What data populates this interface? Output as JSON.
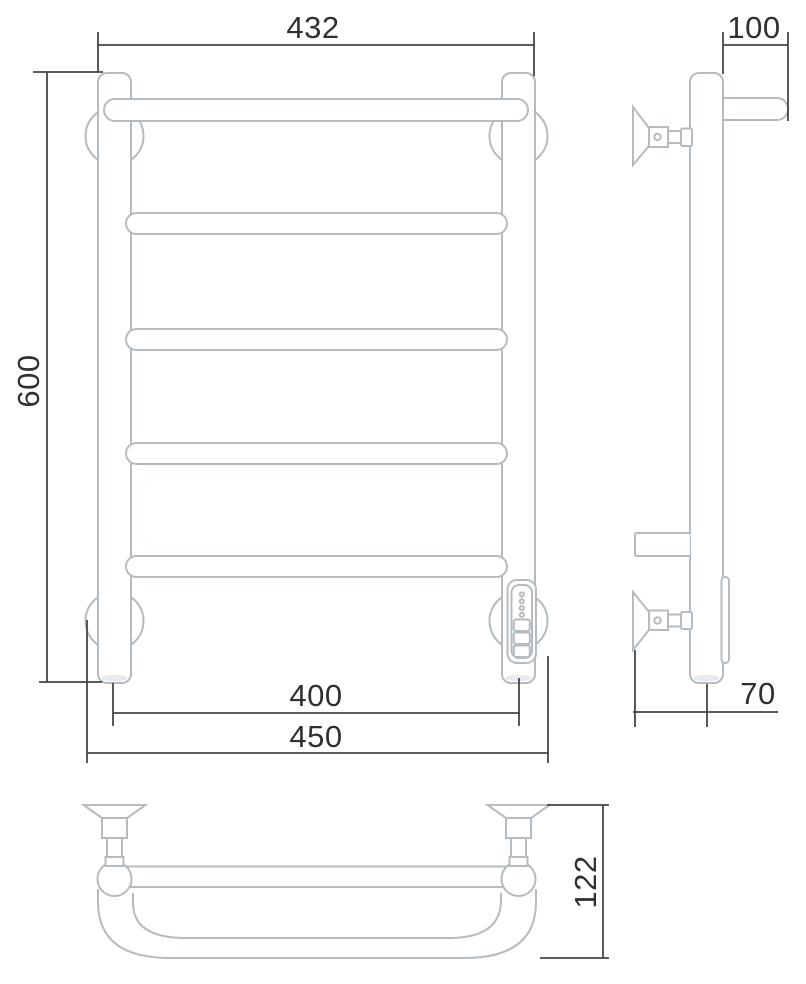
{
  "drawing": {
    "kind": "technical-dimension-drawing",
    "subject": "ladder towel rail shown in front, side and bottom orthographic views",
    "colors": {
      "background": "#ffffff",
      "outline": "#b4bcc2",
      "dimension_lines": "#43474c",
      "dimension_text": "#2e3134"
    },
    "dimensions": {
      "front_width_top": "432",
      "front_height": "600",
      "front_span_centers": "400",
      "front_width_bottom": "450",
      "side_top_depth": "100",
      "side_bottom_depth": "70",
      "bottom_view_depth": "122"
    }
  }
}
